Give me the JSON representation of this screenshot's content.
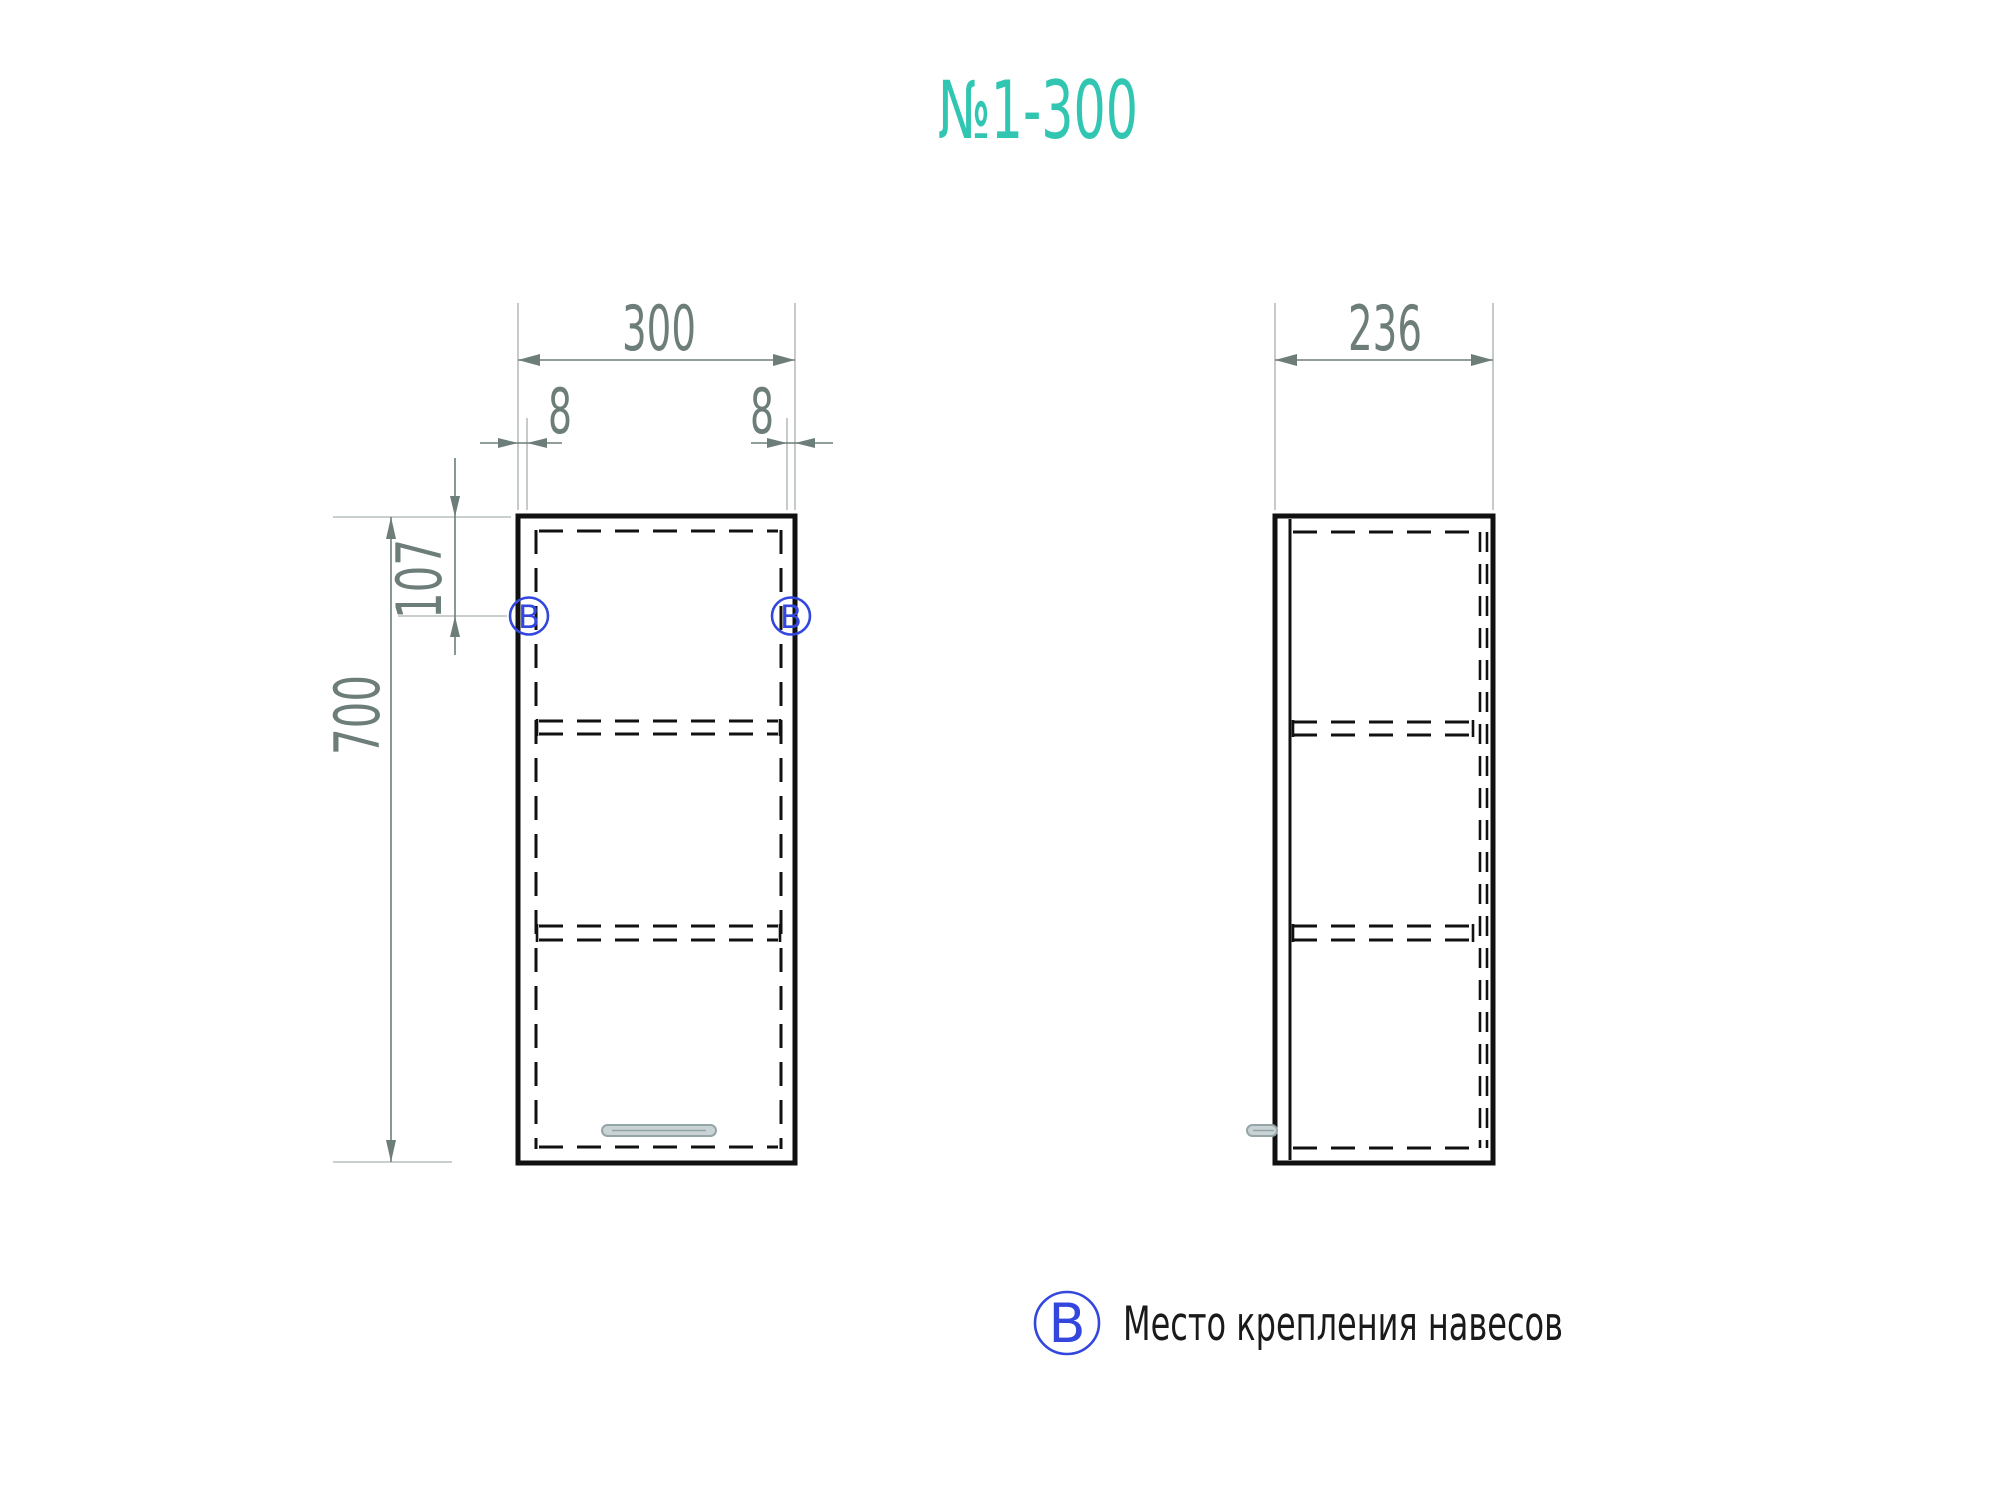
{
  "title": {
    "text": "№1-300"
  },
  "dimensions": {
    "front_width": "300",
    "front_offset_left": "8",
    "front_offset_right": "8",
    "hole_offset_top": "107",
    "front_height": "700",
    "side_depth": "236"
  },
  "markers": {
    "mount_letter": "В"
  },
  "legend": {
    "symbol": "В",
    "label": "Место крепления навесов"
  },
  "colors": {
    "teal": "#31c6b2",
    "dim_gray": "#6d7d79",
    "extension_gray": "#b7bdbd",
    "line_black": "#111111",
    "blue": "#3347de",
    "text_dark": "#1a1a1a",
    "handle_fill": "#c9d2d4",
    "handle_stroke": "#94a5a8"
  }
}
